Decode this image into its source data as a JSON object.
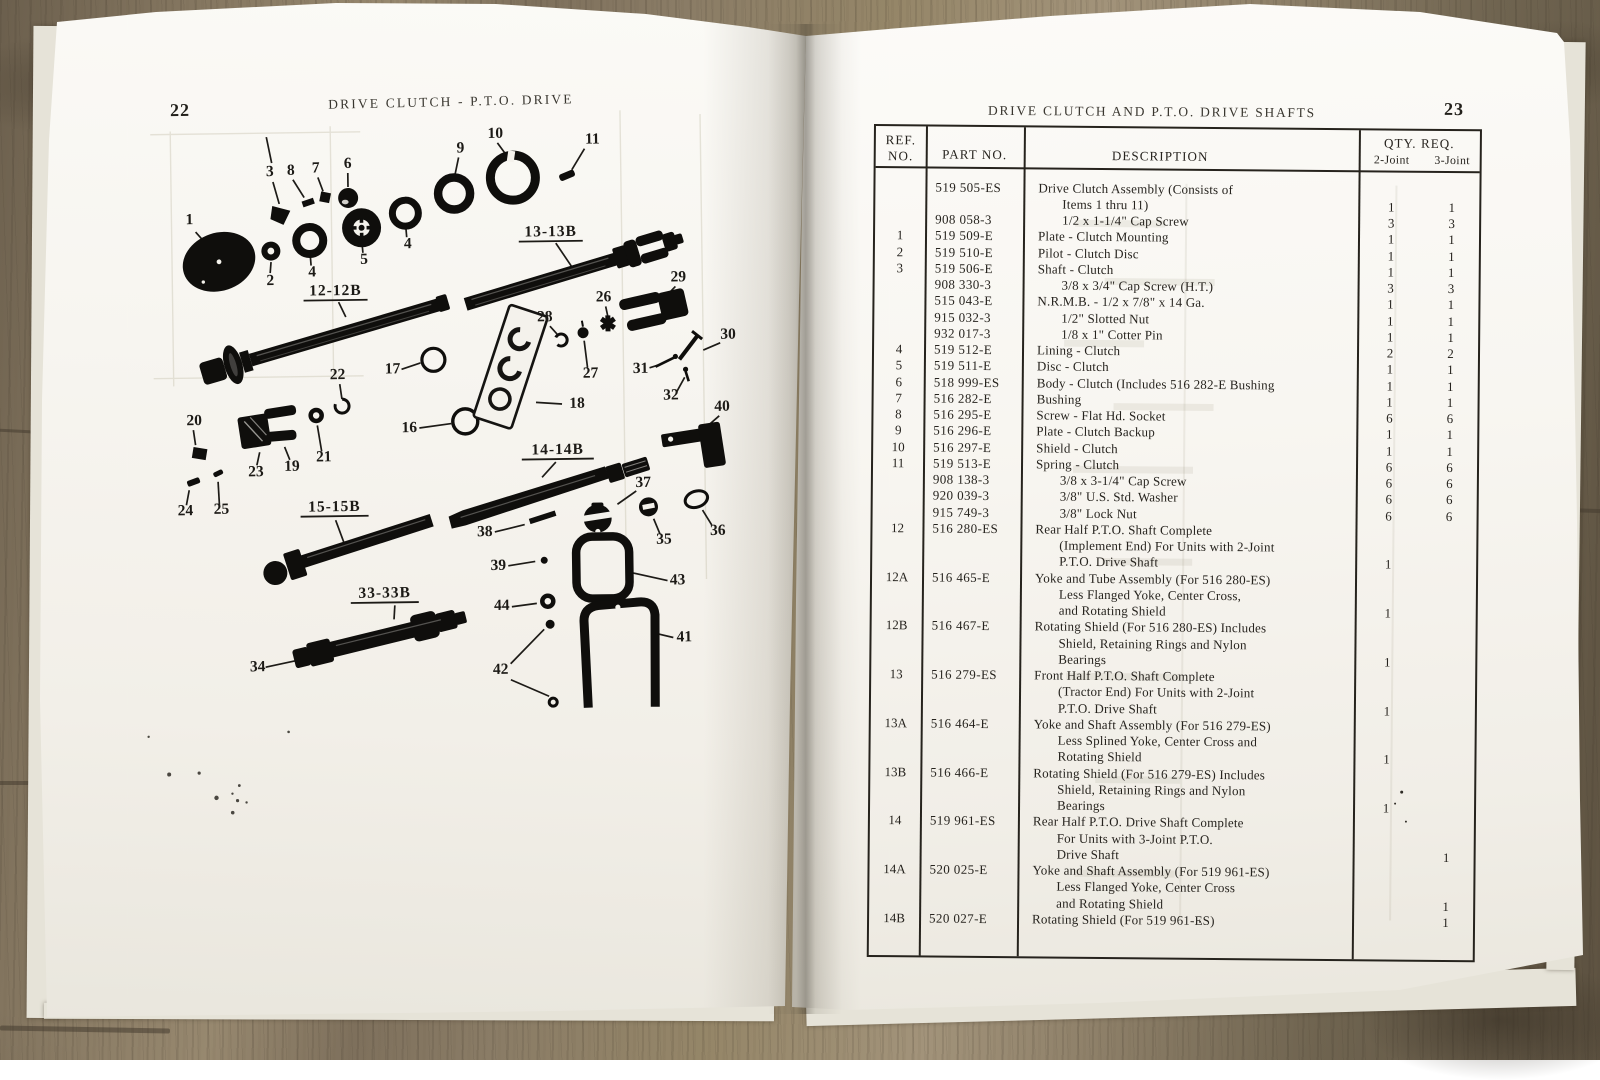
{
  "left_page": {
    "page_number": "22",
    "title": "DRIVE CLUTCH - P.T.O. DRIVE",
    "diagram": {
      "callouts": [
        "1",
        "2",
        "4",
        "5",
        "4",
        "6",
        "7",
        "8",
        "3",
        "9",
        "10",
        "11",
        "13-13B",
        "12-12B",
        "22",
        "17",
        "16",
        "18",
        "28",
        "26",
        "27",
        "29",
        "30",
        "31",
        "32",
        "40",
        "20",
        "23",
        "19",
        "21",
        "24",
        "25",
        "14-14B",
        "37",
        "35",
        "36",
        "38",
        "39",
        "43",
        "41",
        "44",
        "42",
        "33-33B",
        "34",
        "15-15B"
      ]
    }
  },
  "right_page": {
    "page_number": "23",
    "title": "DRIVE CLUTCH AND P.T.O. DRIVE SHAFTS",
    "table": {
      "headers": {
        "ref1": "REF.",
        "ref2": "NO.",
        "part": "PART NO.",
        "desc": "DESCRIPTION",
        "qty": "QTY. REQ.",
        "q2": "2-Joint",
        "q3": "3-Joint"
      },
      "rows": [
        {
          "ref": "",
          "part": "519 505-ES",
          "desc": "Drive Clutch Assembly (Consists of",
          "ind": 0,
          "q2": "",
          "q3": ""
        },
        {
          "ref": "",
          "part": "",
          "desc": "Items 1 thru 11)",
          "ind": 1,
          "q2": "1",
          "q3": "1"
        },
        {
          "ref": "",
          "part": "908 058-3",
          "desc": "1/2 x 1-1/4\" Cap Screw",
          "ind": 1,
          "q2": "3",
          "q3": "3"
        },
        {
          "ref": "1",
          "part": "519 509-E",
          "desc": "Plate - Clutch Mounting",
          "ind": 0,
          "q2": "1",
          "q3": "1"
        },
        {
          "ref": "2",
          "part": "519 510-E",
          "desc": "Pilot - Clutch Disc",
          "ind": 0,
          "q2": "1",
          "q3": "1"
        },
        {
          "ref": "3",
          "part": "519 506-E",
          "desc": "Shaft - Clutch",
          "ind": 0,
          "q2": "1",
          "q3": "1"
        },
        {
          "ref": "",
          "part": "908 330-3",
          "desc": "3/8 x 3/4\" Cap Screw (H.T.)",
          "ind": 1,
          "q2": "3",
          "q3": "3"
        },
        {
          "ref": "",
          "part": "515 043-E",
          "desc": "N.R.M.B. - 1/2 x 7/8\" x 14 Ga.",
          "ind": 0,
          "q2": "1",
          "q3": "1"
        },
        {
          "ref": "",
          "part": "915 032-3",
          "desc": "1/2\" Slotted Nut",
          "ind": 1,
          "q2": "1",
          "q3": "1"
        },
        {
          "ref": "",
          "part": "932 017-3",
          "desc": "1/8 x 1\" Cotter Pin",
          "ind": 1,
          "q2": "1",
          "q3": "1"
        },
        {
          "ref": "4",
          "part": "519 512-E",
          "desc": "Lining - Clutch",
          "ind": 0,
          "q2": "2",
          "q3": "2"
        },
        {
          "ref": "5",
          "part": "519 511-E",
          "desc": "Disc - Clutch",
          "ind": 0,
          "q2": "1",
          "q3": "1"
        },
        {
          "ref": "6",
          "part": "518 999-ES",
          "desc": "Body - Clutch (Includes 516 282-E Bushing",
          "ind": 0,
          "q2": "1",
          "q3": "1"
        },
        {
          "ref": "7",
          "part": "516 282-E",
          "desc": "Bushing",
          "ind": 0,
          "q2": "1",
          "q3": "1"
        },
        {
          "ref": "8",
          "part": "516 295-E",
          "desc": "Screw - Flat Hd. Socket",
          "ind": 0,
          "q2": "6",
          "q3": "6"
        },
        {
          "ref": "9",
          "part": "516 296-E",
          "desc": "Plate - Clutch Backup",
          "ind": 0,
          "q2": "1",
          "q3": "1"
        },
        {
          "ref": "10",
          "part": "516 297-E",
          "desc": "Shield - Clutch",
          "ind": 0,
          "q2": "1",
          "q3": "1"
        },
        {
          "ref": "11",
          "part": "519 513-E",
          "desc": "Spring - Clutch",
          "ind": 0,
          "q2": "6",
          "q3": "6"
        },
        {
          "ref": "",
          "part": "908 138-3",
          "desc": "3/8 x 3-1/4\" Cap Screw",
          "ind": 1,
          "q2": "6",
          "q3": "6"
        },
        {
          "ref": "",
          "part": "920 039-3",
          "desc": "3/8\" U.S. Std. Washer",
          "ind": 1,
          "q2": "6",
          "q3": "6"
        },
        {
          "ref": "",
          "part": "915 749-3",
          "desc": "3/8\" Lock Nut",
          "ind": 1,
          "q2": "6",
          "q3": "6"
        },
        {
          "ref": "12",
          "part": "516 280-ES",
          "desc": "Rear Half P.T.O. Shaft Complete",
          "ind": 0,
          "q2": "",
          "q3": ""
        },
        {
          "ref": "",
          "part": "",
          "desc": "(Implement End) For Units with 2-Joint",
          "ind": 1,
          "q2": "",
          "q3": ""
        },
        {
          "ref": "",
          "part": "",
          "desc": "P.T.O. Drive Shaft",
          "ind": 1,
          "q2": "1",
          "q3": ""
        },
        {
          "ref": "12A",
          "part": "516 465-E",
          "desc": "Yoke and Tube Assembly (For 516 280-ES)",
          "ind": 0,
          "q2": "",
          "q3": ""
        },
        {
          "ref": "",
          "part": "",
          "desc": "Less Flanged Yoke, Center Cross,",
          "ind": 1,
          "q2": "",
          "q3": ""
        },
        {
          "ref": "",
          "part": "",
          "desc": "and Rotating Shield",
          "ind": 1,
          "q2": "1",
          "q3": ""
        },
        {
          "ref": "12B",
          "part": "516 467-E",
          "desc": "Rotating Shield (For 516 280-ES) Includes",
          "ind": 0,
          "q2": "",
          "q3": ""
        },
        {
          "ref": "",
          "part": "",
          "desc": "Shield, Retaining Rings and Nylon",
          "ind": 1,
          "q2": "",
          "q3": ""
        },
        {
          "ref": "",
          "part": "",
          "desc": "Bearings",
          "ind": 1,
          "q2": "1",
          "q3": ""
        },
        {
          "ref": "13",
          "part": "516 279-ES",
          "desc": "Front Half P.T.O. Shaft Complete",
          "ind": 0,
          "q2": "",
          "q3": ""
        },
        {
          "ref": "",
          "part": "",
          "desc": "(Tractor End) For Units with 2-Joint",
          "ind": 1,
          "q2": "",
          "q3": ""
        },
        {
          "ref": "",
          "part": "",
          "desc": "P.T.O. Drive Shaft",
          "ind": 1,
          "q2": "1",
          "q3": ""
        },
        {
          "ref": "13A",
          "part": "516 464-E",
          "desc": "Yoke and Shaft Assembly (For 516 279-ES)",
          "ind": 0,
          "q2": "",
          "q3": ""
        },
        {
          "ref": "",
          "part": "",
          "desc": "Less Splined Yoke, Center Cross and",
          "ind": 1,
          "q2": "",
          "q3": ""
        },
        {
          "ref": "",
          "part": "",
          "desc": "Rotating Shield",
          "ind": 1,
          "q2": "1",
          "q3": ""
        },
        {
          "ref": "13B",
          "part": "516 466-E",
          "desc": "Rotating Shield (For 516 279-ES) Includes",
          "ind": 0,
          "q2": "",
          "q3": ""
        },
        {
          "ref": "",
          "part": "",
          "desc": "Shield, Retaining Rings and Nylon",
          "ind": 1,
          "q2": "",
          "q3": ""
        },
        {
          "ref": "",
          "part": "",
          "desc": "Bearings",
          "ind": 1,
          "q2": "1",
          "q3": ""
        },
        {
          "ref": "14",
          "part": "519 961-ES",
          "desc": "Rear Half P.T.O. Drive Shaft Complete",
          "ind": 0,
          "q2": "",
          "q3": ""
        },
        {
          "ref": "",
          "part": "",
          "desc": "For Units with 3-Joint P.T.O.",
          "ind": 1,
          "q2": "",
          "q3": ""
        },
        {
          "ref": "",
          "part": "",
          "desc": "Drive Shaft",
          "ind": 1,
          "q2": "",
          "q3": "1"
        },
        {
          "ref": "14A",
          "part": "520 025-E",
          "desc": "Yoke and Shaft Assembly (For 519 961-ES)",
          "ind": 0,
          "q2": "",
          "q3": ""
        },
        {
          "ref": "",
          "part": "",
          "desc": "Less Flanged Yoke, Center Cross",
          "ind": 1,
          "q2": "",
          "q3": ""
        },
        {
          "ref": "",
          "part": "",
          "desc": "and Rotating Shield",
          "ind": 1,
          "q2": "",
          "q3": "1"
        },
        {
          "ref": "14B",
          "part": "520 027-E",
          "desc": "Rotating Shield (For 519 961-ES)",
          "ind": 0,
          "q2": "",
          "q3": "1"
        }
      ]
    }
  }
}
